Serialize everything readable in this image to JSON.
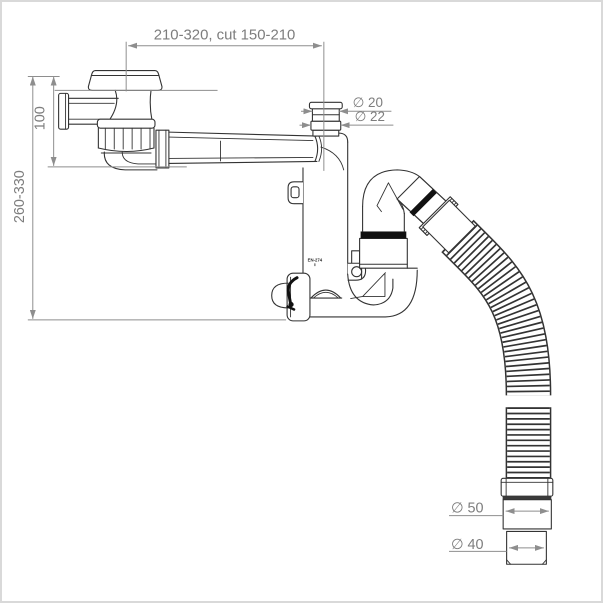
{
  "labels": {
    "top_span": "210-320, cut 150-210",
    "height_upper": "100",
    "height_overall": "260-330",
    "dia_nozzle_outer": "∅ 20",
    "dia_nozzle_inner": "∅ 22",
    "dia_outlet_upper": "∅ 50",
    "dia_outlet_lower": "∅ 40",
    "marking": "EN-274"
  },
  "colors": {
    "line": "#333333",
    "dim": "#8e8e8e",
    "dimtext": "#7d7d7d",
    "seal": "#111111",
    "bg": "#ffffff",
    "border": "#d9d9d9"
  }
}
